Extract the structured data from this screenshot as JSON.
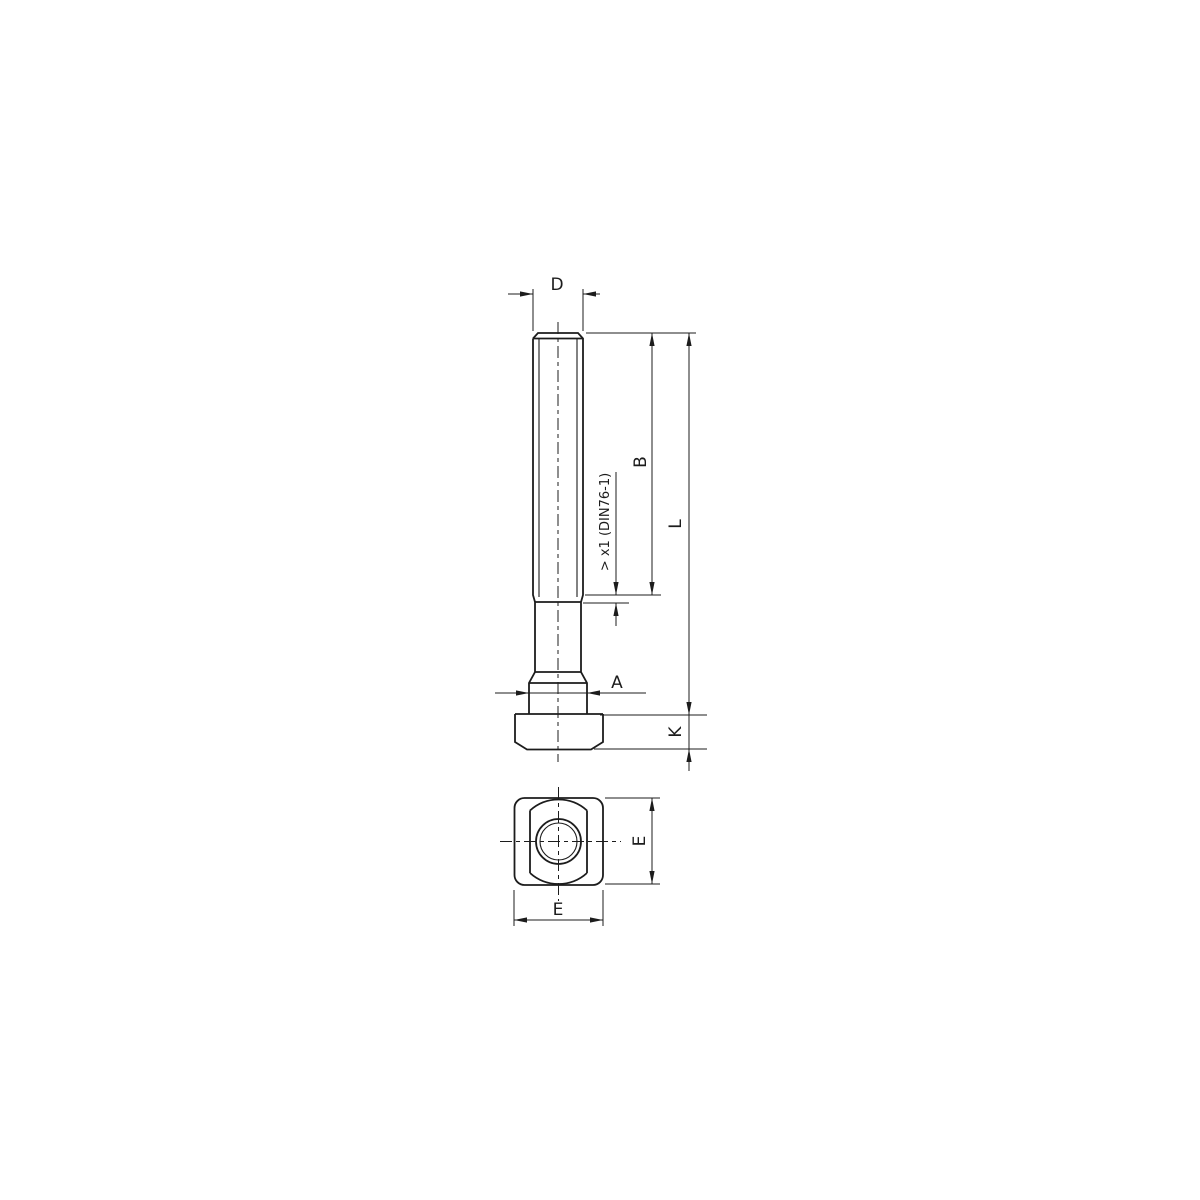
{
  "drawing": {
    "labels": {
      "thread_diameter": "D",
      "thread_length": "B",
      "total_length": "L",
      "collar_diameter": "A",
      "head_height": "K",
      "head_size_side": "E",
      "head_size_bottom": "E",
      "thread_runout_note": "> x1 (DIN76-1)"
    },
    "colors": {
      "line": "#1c1c1c",
      "background": "#ffffff"
    }
  }
}
